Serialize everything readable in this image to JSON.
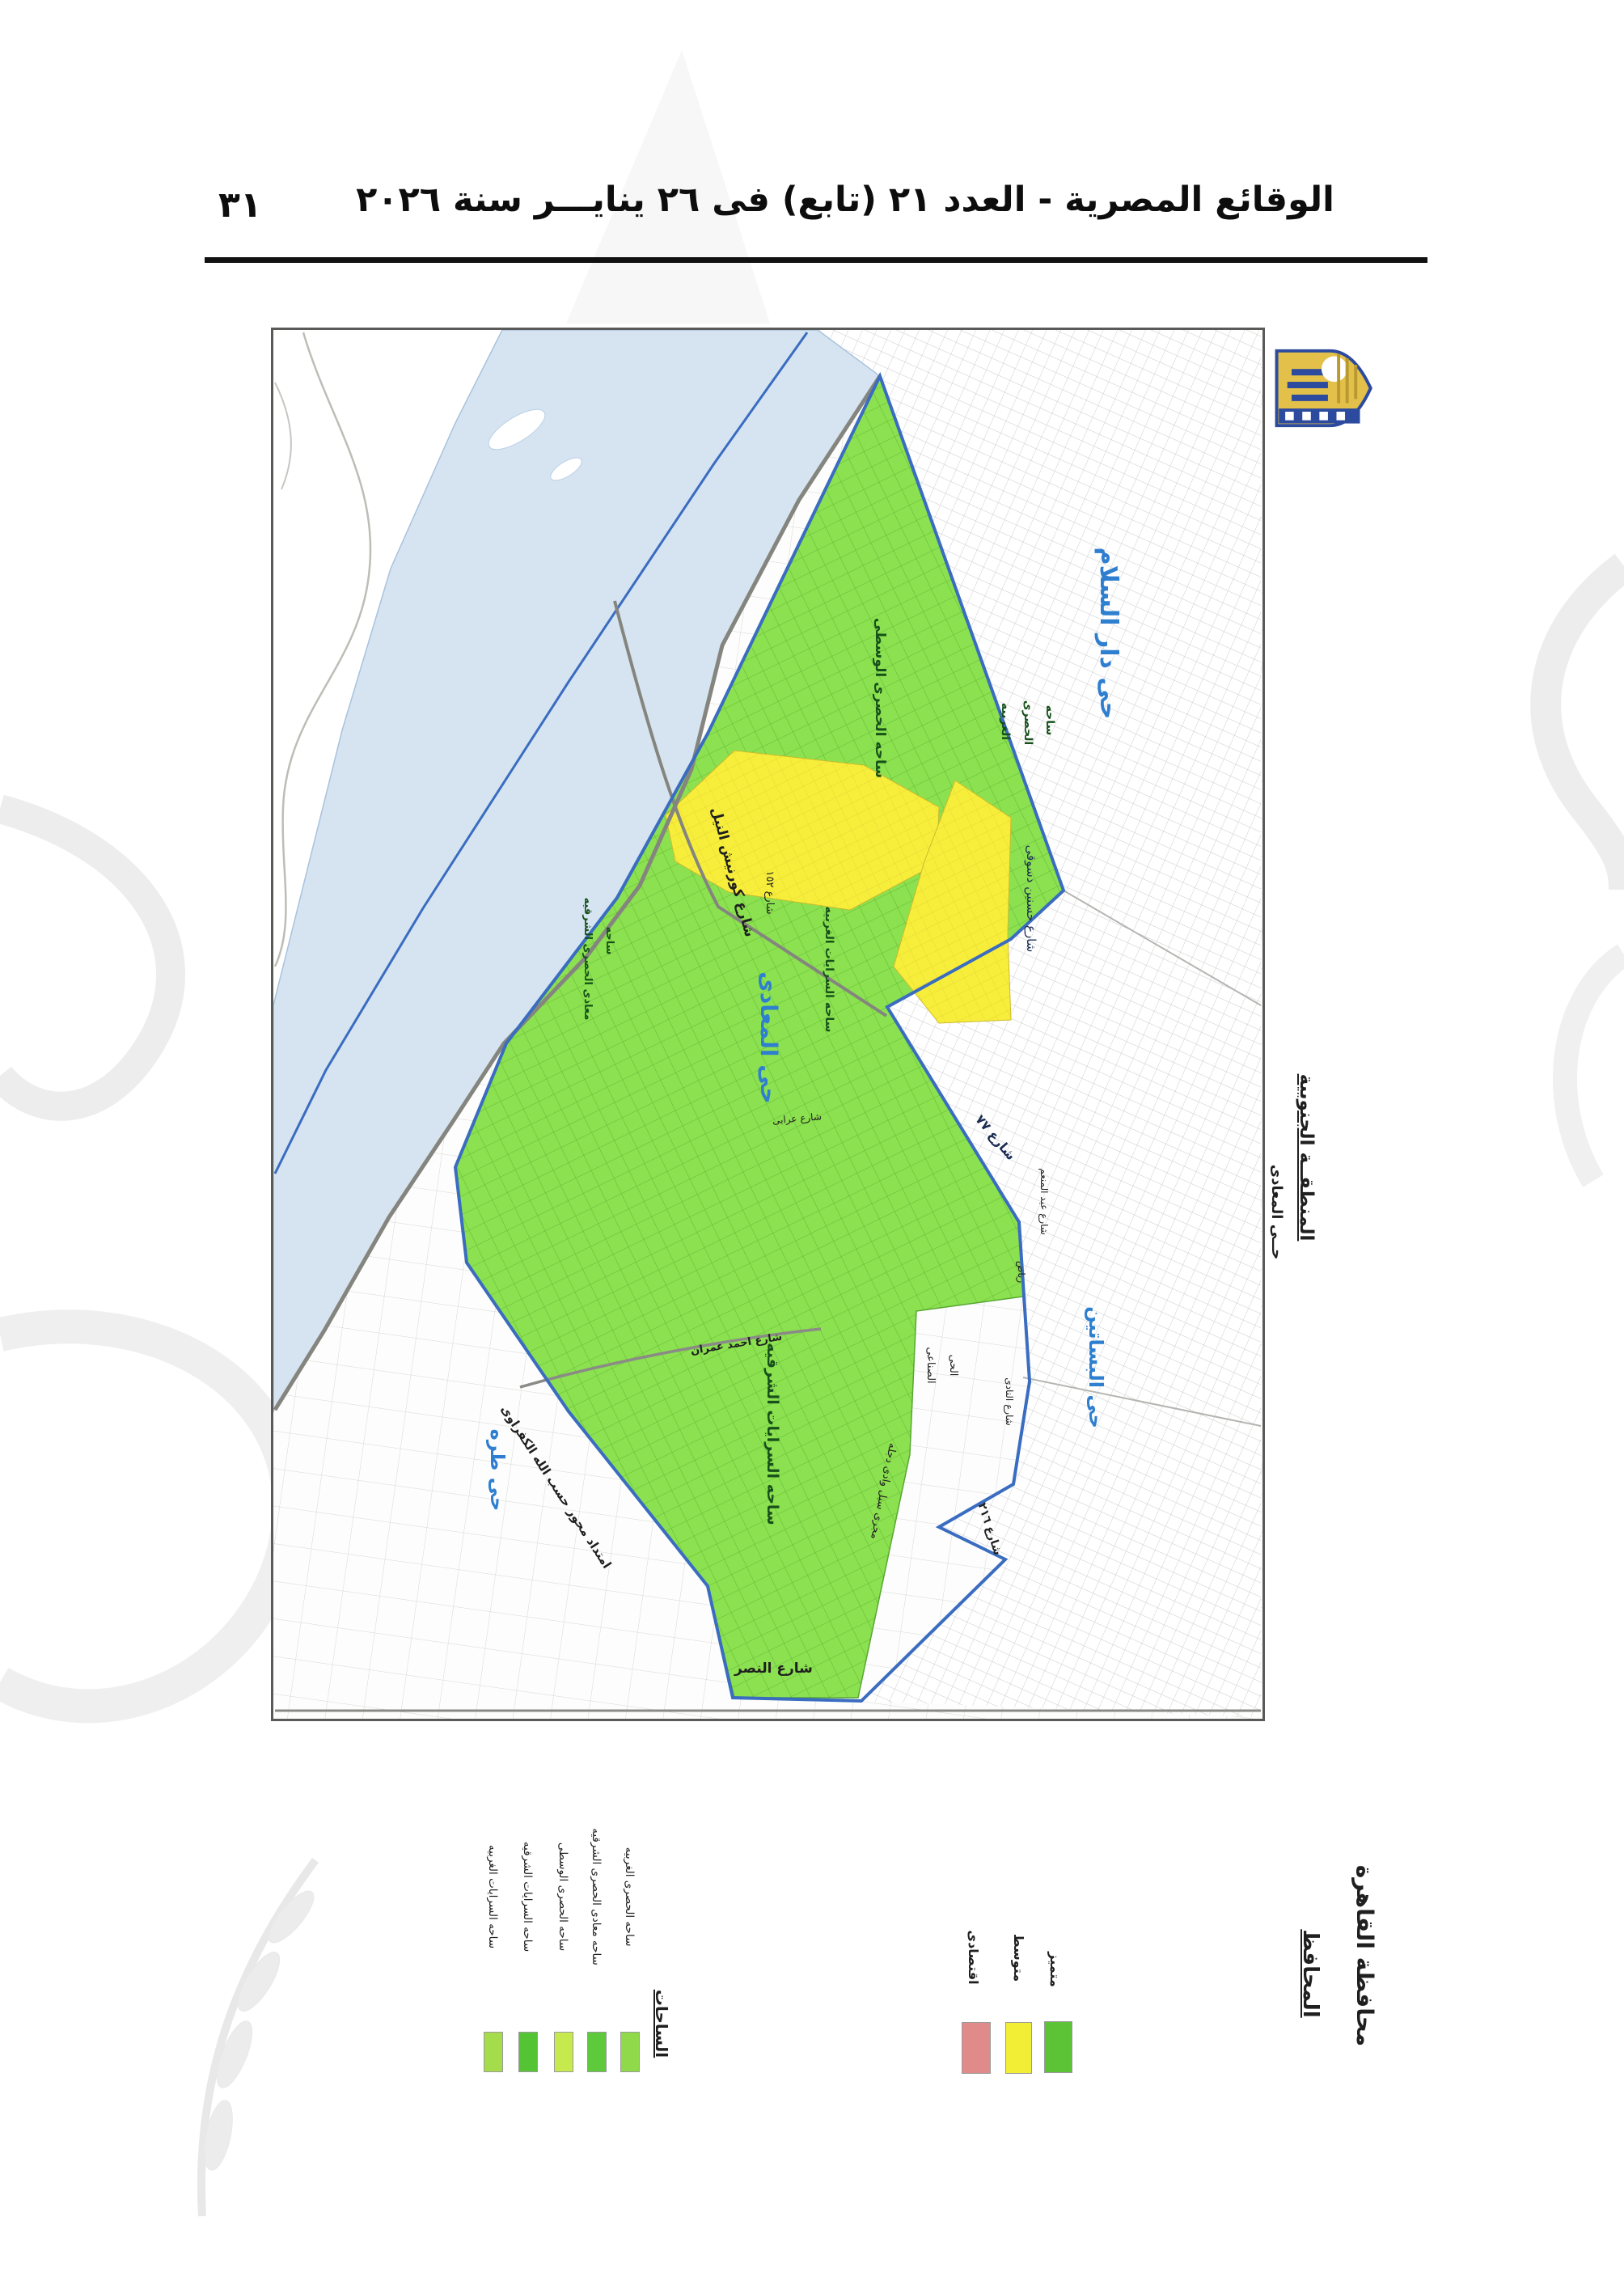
{
  "page": {
    "title": "الوقائع المصرية - العدد ٢١ (تابع) فى ٢٦ ينايـــر سنة ٢٠٢٦",
    "page_number": "٣١"
  },
  "map_frame": {
    "districts": {
      "dar_el_salam": "حى دار السلام",
      "maadi": "حى المعادى",
      "basateen": "حى البساتين",
      "tura": "حى طره"
    },
    "areas": {
      "hosary_wosta": "ساحه الحصرى الوسطى",
      "hosary_gharbiya_l1": "ساحه",
      "hosary_gharbiya_l2": "الحصرى",
      "hosary_gharbiya_l3": "الغربيه",
      "maadi_hosary_sharkiya_l1": "ساحه",
      "maadi_hosary_sharkiya_l2": "معادى الحصرى الشرقيه",
      "sarayat_gharbiya": "ساحه السرايات الغربيه",
      "sarayat_sharkiya": "ساحه السرايات الشرقيه",
      "industrial_l1": "الحى",
      "industrial_l2": "الصناعى"
    },
    "streets": {
      "corniche": "شارع كورنيش النيل",
      "street_152": "شارع ١٥٢",
      "street_77": "شارع ٧٧",
      "street_216": "شارع ٢١٦",
      "nasr": "شارع النصر",
      "ahmed_omran": "شارع احمد عمران",
      "orabi": "شارع عرابى",
      "hassanein_dessouky": "شارع حسنين دسوقى",
      "abdel_moneim_l1": "شارع عبد المنعم",
      "abdel_moneim_l2": "رياض",
      "el_nady": "شارع النادى",
      "kafrawy": "امتداد محور حسب الله الكفراوى",
      "magra_seil": "مجرى سيل وادى دجله"
    },
    "side_note_l1": "المنطقــة الجنوبية",
    "side_note_l2": "حــى المعادى"
  },
  "legend": {
    "title": "الساحات",
    "items": [
      {
        "label": "ساحه الحصرى الغربيه",
        "color": "#8fd94a"
      },
      {
        "label": "ساحه معادى الحصرى الشرقيه",
        "color": "#5ec93a"
      },
      {
        "label": "ساحه الحصرى الوسطى",
        "color": "#c6e94e"
      },
      {
        "label": "ساحه السرايات الشرقيه",
        "color": "#54c434"
      },
      {
        "label": "ساحه السرايات الغربيه",
        "color": "#a5dc4b"
      }
    ],
    "ratings": [
      {
        "label": "متميز",
        "color": "#5cc336"
      },
      {
        "label": "متوسط",
        "color": "#f2ee35"
      },
      {
        "label": "اقتصادى",
        "color": "#e08a8a"
      }
    ]
  },
  "signature": {
    "org": "محافظة القاهرة",
    "title": "المحافظ"
  },
  "logo": {
    "name": "شعار محافظة القاهرة"
  },
  "colors": {
    "zone_green": "#8be14f",
    "zone_yellow": "#f6ee3b",
    "river": "#d6e4f1",
    "boundary": "#3a6cc0",
    "road": "#85857f"
  }
}
